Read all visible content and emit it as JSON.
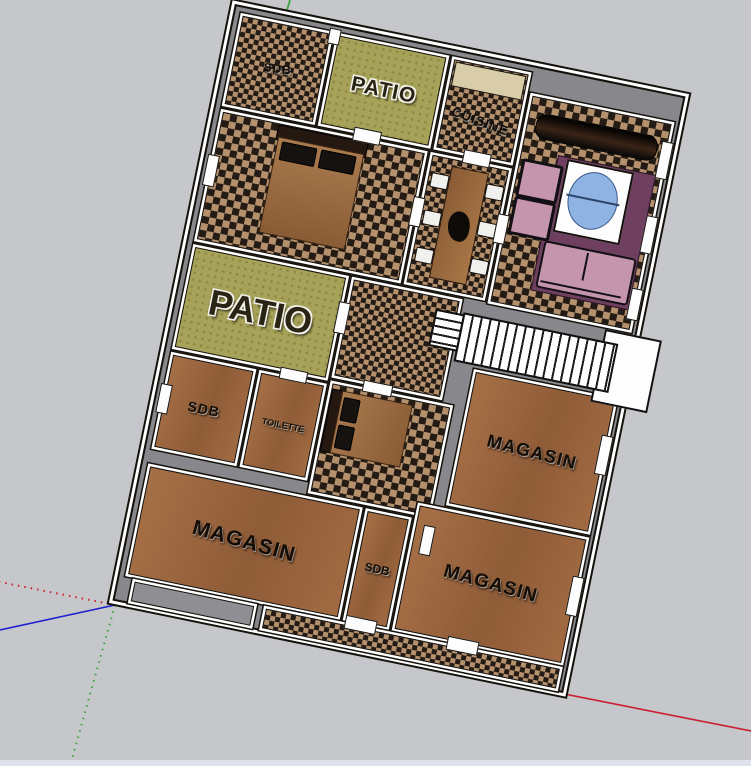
{
  "labels": {
    "sdb_top": "SDB",
    "patio_top": "PATIO",
    "cuisine": "CUISINE",
    "patio_main": "PATIO",
    "sdb_left": "SDB",
    "toilette": "TOILETTE",
    "magasin_right": "MAGASIN",
    "magasin_bottom_left": "MAGASIN",
    "sdb_corridor": "SDB",
    "magasin_bottom_right": "MAGASIN"
  },
  "colors": {
    "bg": "#c6c7cb",
    "wall": "#87878c",
    "edge": "#15110c",
    "outline": "#ffffff",
    "checkerDark": "#241c14",
    "checkerTan": "#b4906d",
    "wood": "#9c6740",
    "grass": "#a6a259",
    "bedBrown": "#9e6f45",
    "darkFurn": "#17130f",
    "sofaPink": "#c495ad",
    "rugPurple": "#6f3f60",
    "tableBlue": "#8fb4e4",
    "counterBeige": "#d9cda9",
    "axisRed": "#cc1f2e",
    "axisGreen": "#37a63d",
    "axisBlue": "#1f22cc"
  },
  "shapes": {
    "double_bed": "brown rectangle with dark pillows",
    "single_bed": "brown rectangle with dark pillows",
    "dining_table": "wood plank with plant and six white chairs",
    "kitchen_counter": "beige strip",
    "tv_console": "dark rounded bar",
    "armchair": "pink square",
    "sofa": "pink rectangle",
    "coffee_table": "white square with blue oval top",
    "rug": "purple rectangle",
    "staircase": "white run with step lines"
  }
}
